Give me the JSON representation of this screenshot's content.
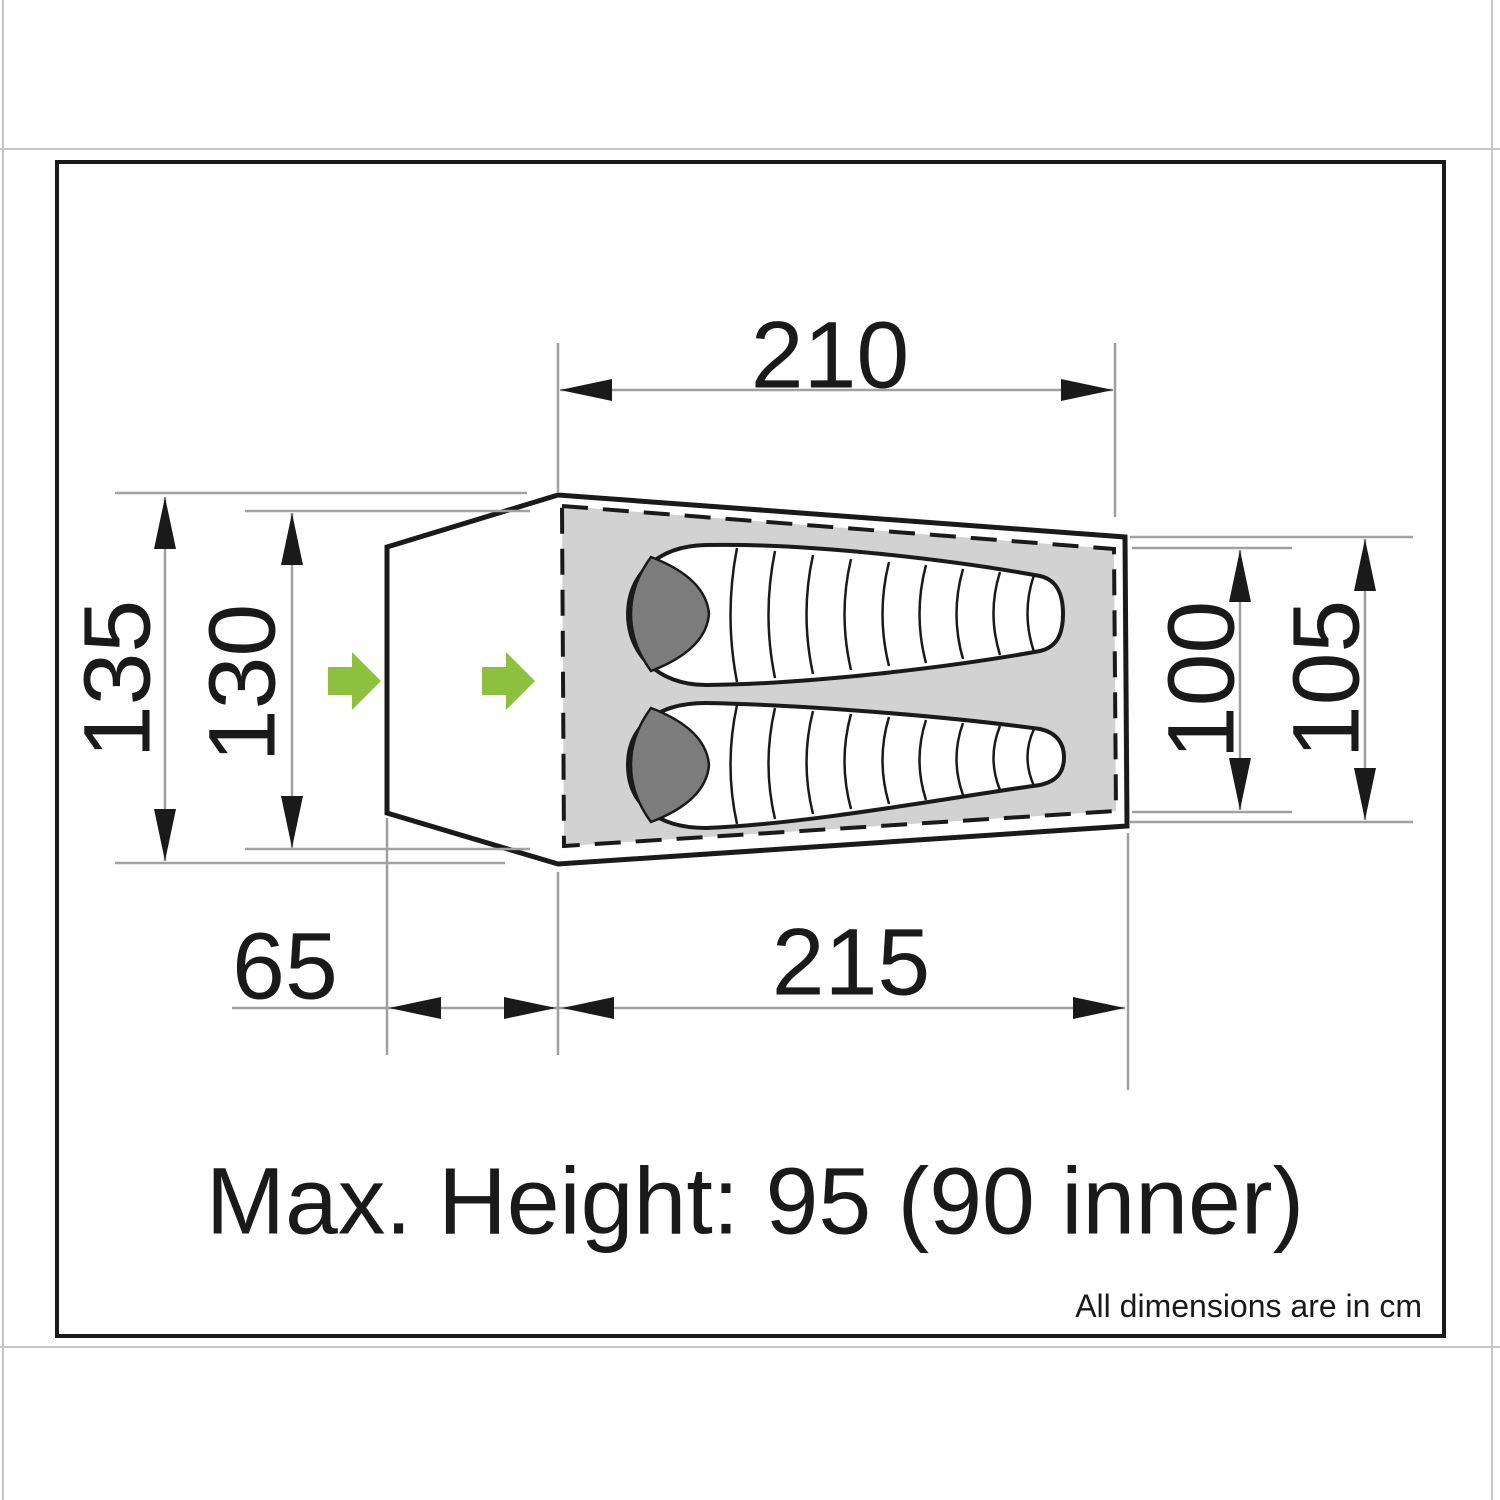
{
  "diagram": {
    "dimensions": {
      "inner_length_top": "210",
      "outer_length_bottom": "215",
      "vestibule_depth": "65",
      "outer_width_left": "135",
      "inner_width_left": "130",
      "inner_width_right": "100",
      "outer_width_right": "105"
    },
    "notes": {
      "max_height": "Max. Height: 95 (90 inner)",
      "units": "All dimensions are in cm"
    },
    "colors": {
      "outline": "#1a1a1a",
      "dimension_line": "#a0a0a0",
      "inner_floor_fill": "#d2d2d2",
      "hood_fill": "#7c7c7c",
      "entrance_arrow": "#8dc03e",
      "page_edge_line": "#c6c6c6"
    },
    "icons": {
      "entrance_arrow": "right-arrow-icon"
    }
  }
}
